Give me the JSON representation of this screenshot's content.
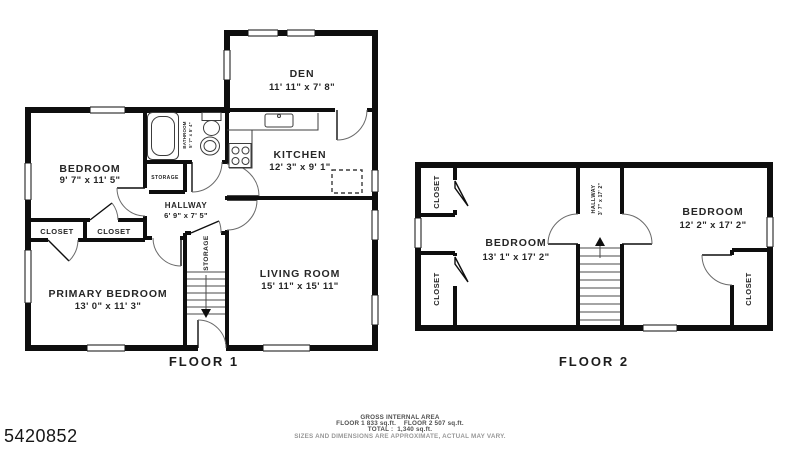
{
  "page": {
    "listing_id": "5420852"
  },
  "floor1": {
    "label": "FLOOR 1",
    "rooms": {
      "den": {
        "name": "DEN",
        "dims": "11' 11\" x 7' 8\""
      },
      "kitchen": {
        "name": "KITCHEN",
        "dims": "12' 3\" x 9' 1\""
      },
      "bedroom": {
        "name": "BEDROOM",
        "dims": "9' 7\" x 11' 5\""
      },
      "bathroom": {
        "name": "BATHROOM",
        "dims": "5' 7\" x 5' 4\""
      },
      "hallway": {
        "name": "HALLWAY",
        "dims": "6' 9\" x 7' 5\""
      },
      "living_room": {
        "name": "LIVING ROOM",
        "dims": "15' 11\" x 15' 11\""
      },
      "primary_bedroom": {
        "name": "PRIMARY BEDROOM",
        "dims": "13' 0\" x 11' 3\""
      },
      "closet_left": {
        "name": "CLOSET"
      },
      "closet_right": {
        "name": "CLOSET"
      },
      "storage_small": {
        "name": "STORAGE"
      },
      "storage_stairs": {
        "name": "STORAGE"
      }
    }
  },
  "floor2": {
    "label": "FLOOR 2",
    "rooms": {
      "bedroom_left": {
        "name": "BEDROOM",
        "dims": "13' 1\" x 17' 2\""
      },
      "bedroom_right": {
        "name": "BEDROOM",
        "dims": "12' 2\" x 17' 2\""
      },
      "hallway": {
        "name": "HALLWAY",
        "dims": "3' 7\" x 17' 2\""
      },
      "closet_top_left": {
        "name": "CLOSET"
      },
      "closet_bottom_left": {
        "name": "CLOSET"
      },
      "closet_bottom_right": {
        "name": "CLOSET"
      }
    }
  },
  "footer": {
    "title": "GROSS INTERNAL AREA",
    "areas_line": "FLOOR 1 833 sq.ft.    FLOOR 2 507 sq.ft.",
    "total_line": "TOTAL :  1,340 sq.ft.",
    "disclaimer": "SIZES AND DIMENSIONS ARE APPROXIMATE, ACTUAL MAY VARY."
  },
  "colors": {
    "wall": "#0e0e0e",
    "fixture_line": "#3c3c3c",
    "text": "#262626",
    "muted_text": "#989898"
  }
}
